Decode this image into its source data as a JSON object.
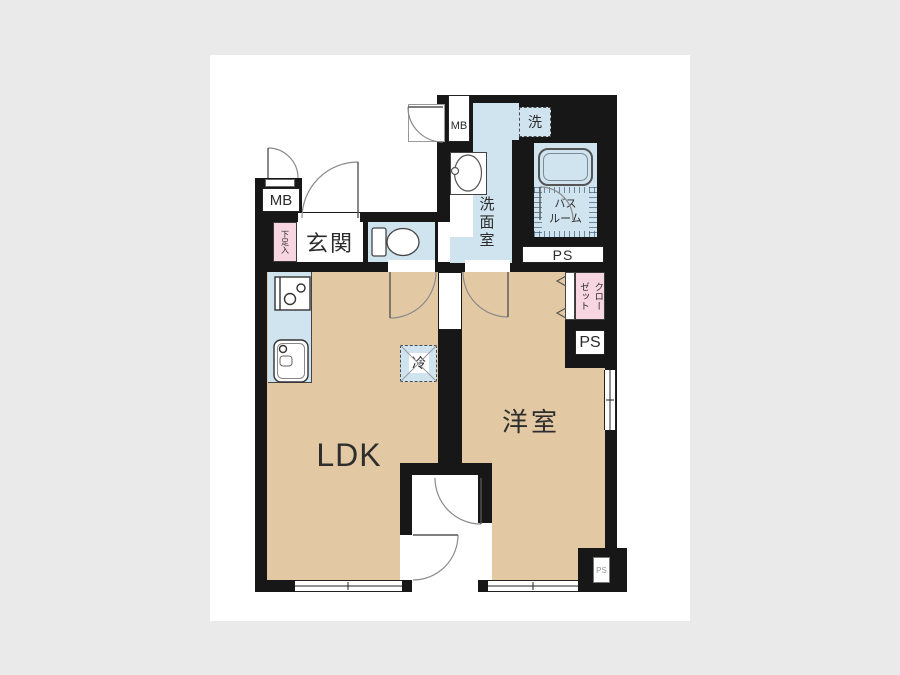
{
  "colors": {
    "page_bg": "#eaeaea",
    "card_bg": "#ffffff",
    "wall": "#171717",
    "room_beige": "#e3c9a3",
    "wet_area_blue": "#cfe4ef",
    "closet_pink": "#f7d6e1"
  },
  "rooms": {
    "ldk": "LDK",
    "western_room": "洋室",
    "entrance": "玄関",
    "washroom": "洗面室",
    "bathroom": "バス\nルーム",
    "closet": "クロー\nゼット",
    "shoe_cabinet": "下足入"
  },
  "fixtures": {
    "washer_space": "洗",
    "fridge_space": "冷"
  },
  "utility": {
    "mb_left": "MB",
    "mb_right": "MB",
    "ps_top": "PS",
    "ps_right": "PS",
    "ps_bottom": "PS"
  }
}
